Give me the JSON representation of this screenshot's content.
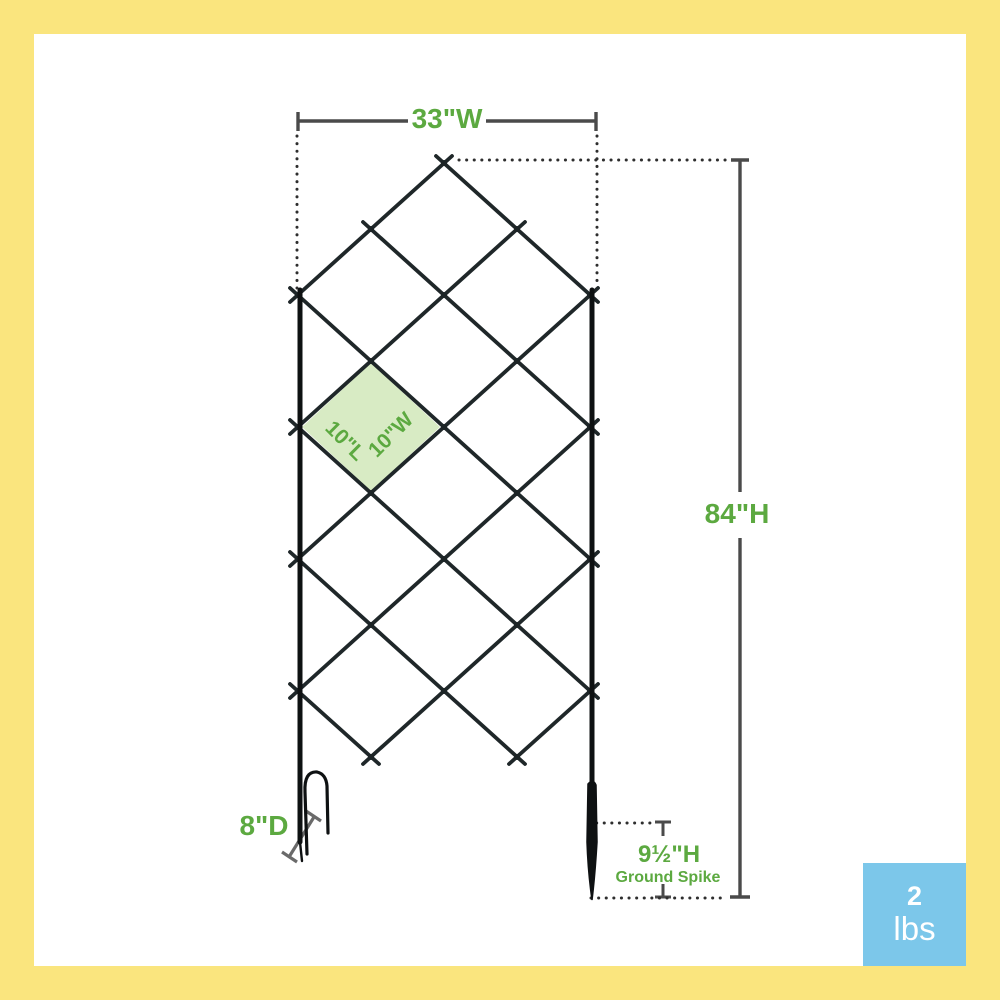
{
  "frame": {
    "border_color": "#FAE57E",
    "canvas_color": "#FFFFFF"
  },
  "dimensions": {
    "width_label": "33\"W",
    "height_label": "84\"H",
    "depth_label": "8\"D",
    "spike_height_label": "9½\"H",
    "spike_caption": "Ground Spike",
    "cell_length_label": "10\"L",
    "cell_width_label": "10\"W"
  },
  "weight_badge": {
    "value": "2",
    "unit": "lbs",
    "background_color": "#7CC7EA",
    "text_color": "#FFFFFF"
  },
  "colors": {
    "accent_green": "#5CA940",
    "dimension_gray": "#4A4A4A",
    "dotted_guide": "#2E2E2E",
    "wire_dark": "#1F2729",
    "frame_black": "#0E1112",
    "cell_fill_green": "#D8EBC4"
  }
}
